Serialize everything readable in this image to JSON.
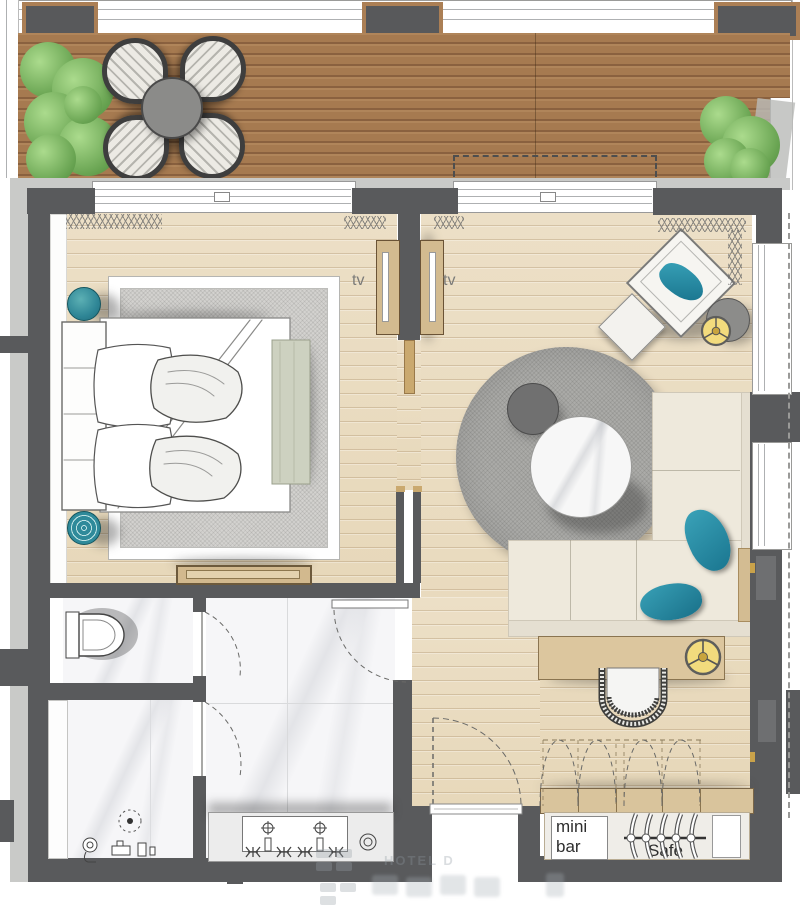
{
  "labels": {
    "tv_left": "tv",
    "tv_right": "tv",
    "minibar_line1": "mini",
    "minibar_line2": "bar",
    "safe": "Safe"
  },
  "watermark": {
    "text": "HOTEL D"
  },
  "colors": {
    "wall_dark": "#595a5c",
    "wall_light": "#c9cac8",
    "deck_wood": "#a87c54",
    "floor_wood": "#e9dcc4",
    "marble": "#f6f6f8",
    "rug_gray": "#ababa8",
    "sofa_cream": "#eee9dc",
    "accent_teal": "#2d93ab",
    "accent_yellow": "#f2db7d",
    "desk_wood": "#dcc69e",
    "plant_green": "#7fb661"
  }
}
